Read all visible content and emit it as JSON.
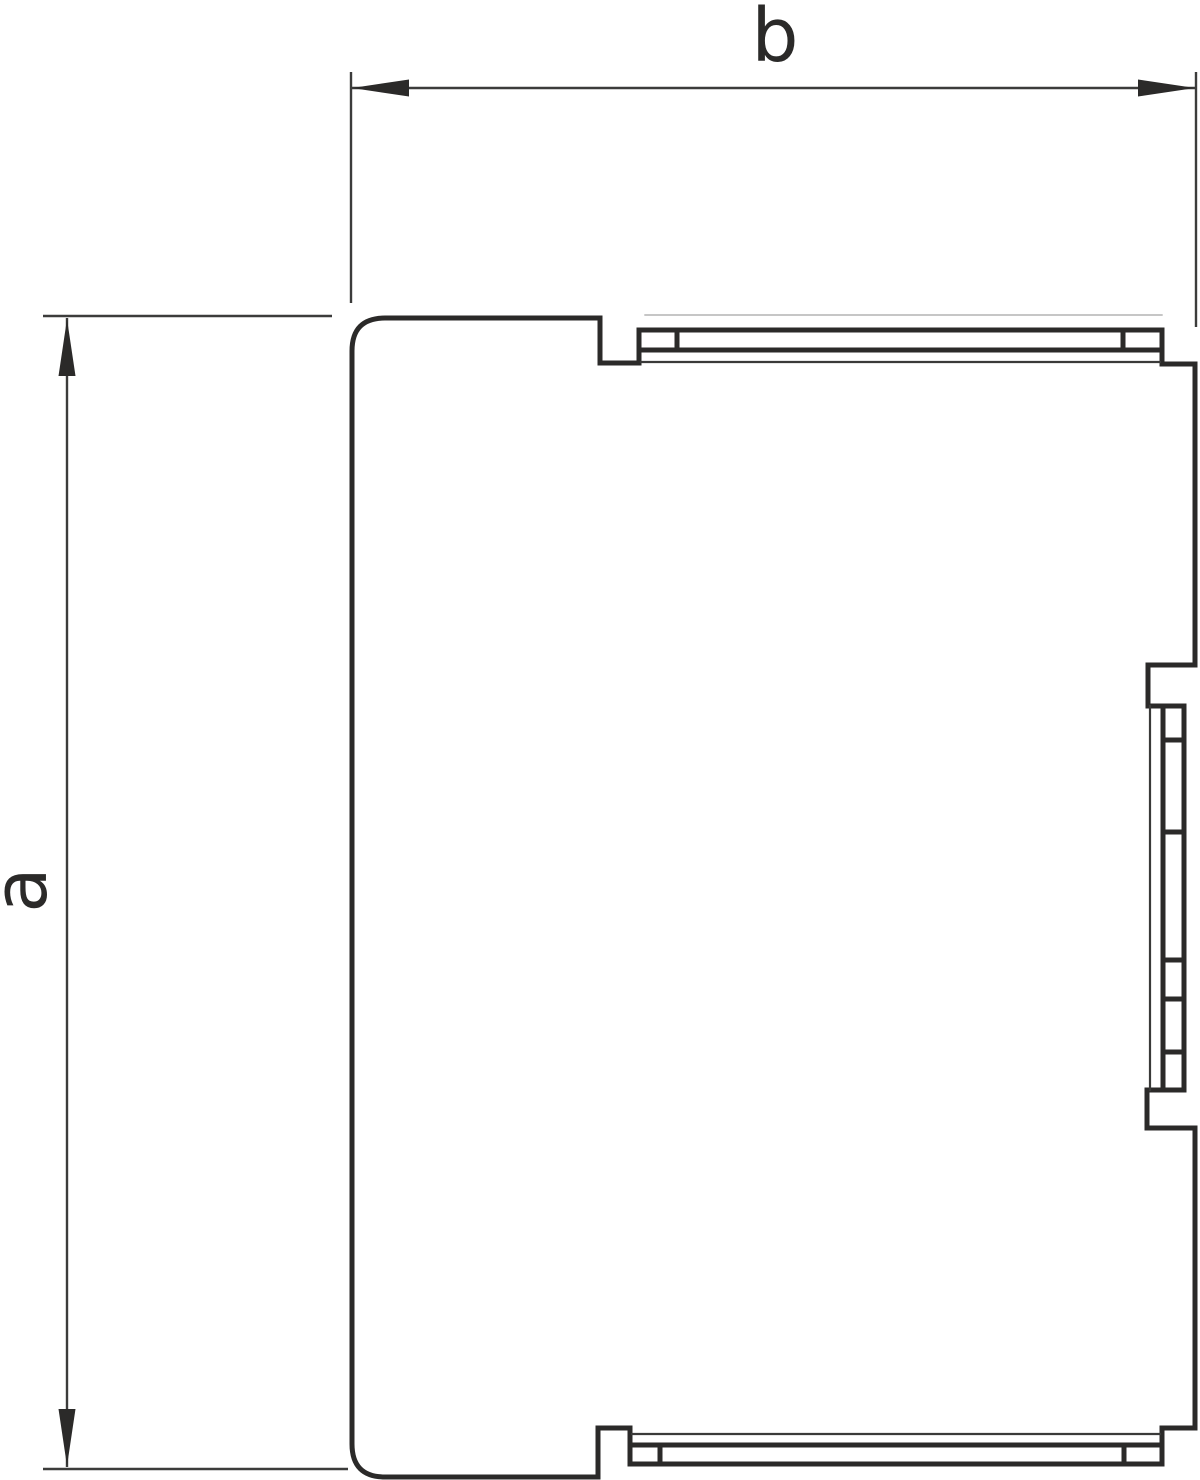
{
  "drawing": {
    "type": "technical-line-drawing-side-view",
    "width_dimension": {
      "label": "b"
    },
    "height_dimension": {
      "label": "a"
    },
    "colors": {
      "background": "#ffffff",
      "outline": "#2b2a29",
      "thin_edge": "#3a3a39",
      "hairline": "#b3b3b3",
      "dimension": "#3c3c3b"
    }
  }
}
